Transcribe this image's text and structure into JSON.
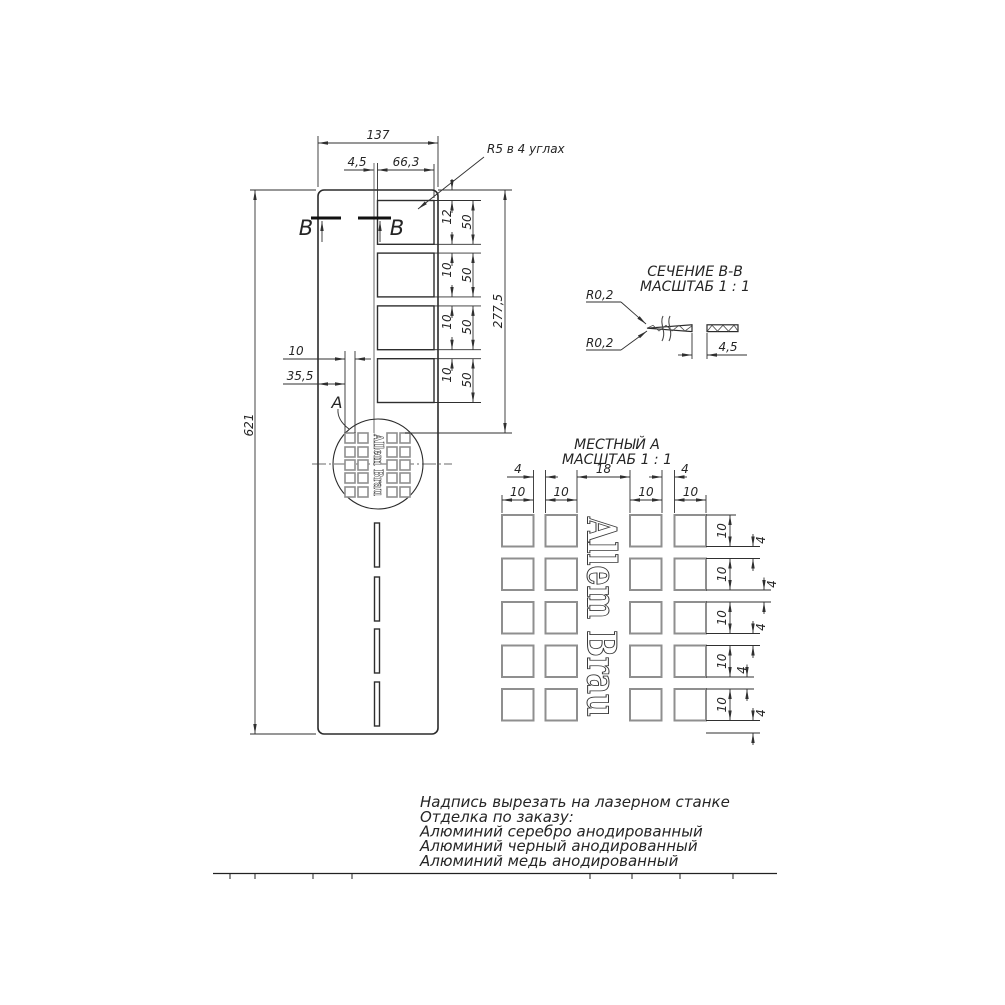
{
  "main": {
    "width_total": "137",
    "offset_45": "4,5",
    "slot_width": "66,3",
    "corner_note": "R5 в 4 углах",
    "top_gap_12": "12",
    "gaps": [
      "10",
      "10",
      "10"
    ],
    "slot_heights": [
      "50",
      "50",
      "50",
      "50"
    ],
    "span_277": "277,5",
    "height_621": "621",
    "sq_width_10": "10",
    "sq_offset_355": "35,5",
    "section_label_left": "В",
    "section_label_right": "В",
    "detail_label": "А"
  },
  "section": {
    "title_line1": "СЕЧЕНИЕ В-В",
    "title_line2": "МАСШТАБ 1 : 1",
    "radius_top": "R0,2",
    "radius_bottom": "R0,2",
    "thickness": "4,5"
  },
  "detail": {
    "title_line1": "МЕСТНЫЙ А",
    "title_line2": "МАСШТАБ 1 : 1",
    "gap_left": "4",
    "gap_center": "18",
    "gap_right": "4",
    "col_widths": [
      "10",
      "10",
      "10",
      "10"
    ],
    "row_heights": [
      "10",
      "10",
      "10",
      "10",
      "10"
    ],
    "row_gaps": [
      "4",
      "4",
      "4",
      "4",
      "4"
    ],
    "brand": "Allem Brau"
  },
  "notes": [
    "Надпись вырезать на лазерном станке",
    "Отделка по заказу:",
    "Алюминий серебро анодированный",
    "Алюминий черный анодированный",
    "Алюминий медь анодированный"
  ]
}
